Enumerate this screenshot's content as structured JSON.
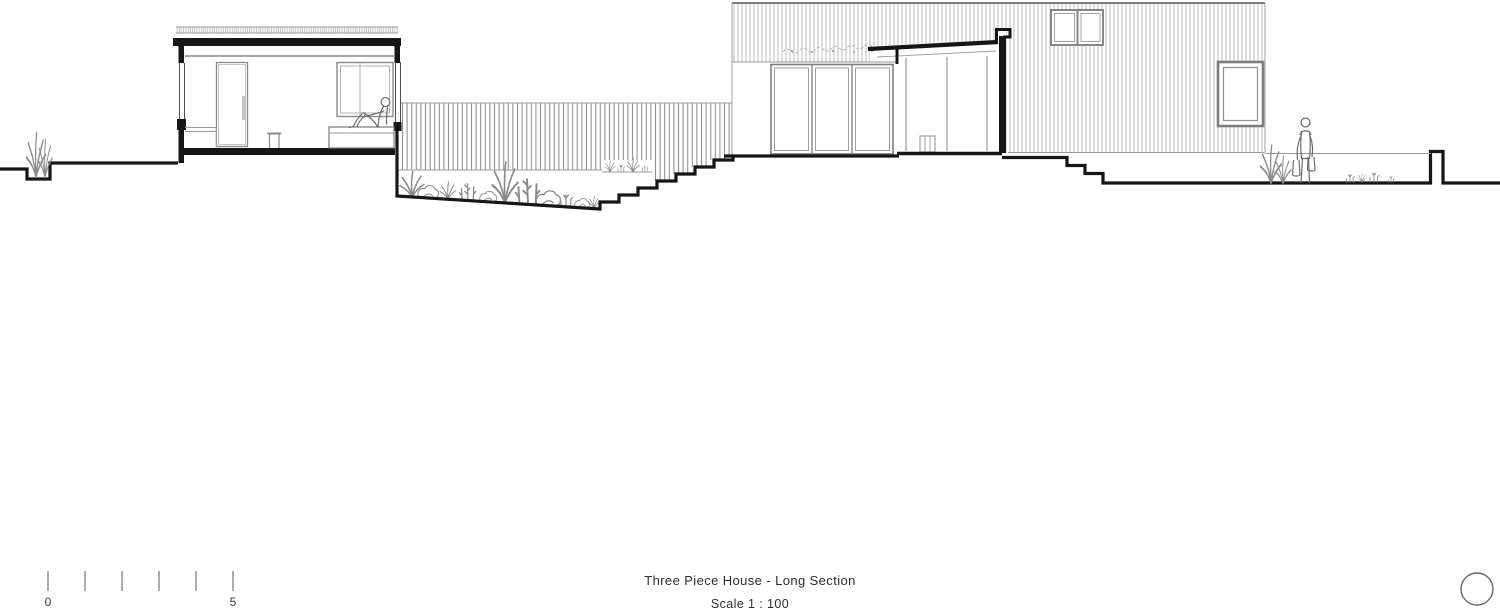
{
  "title_block": {
    "title": "Three Piece House - Long Section",
    "scale_label": "Scale 1 : 100"
  },
  "scale_bar": {
    "start_label": "0",
    "end_label": "5",
    "tick_count": 6
  },
  "colors": {
    "background": "#ffffff",
    "section_line": "#161616",
    "detail_line": "#4d4d4d",
    "frame_line": "#7d7d7d",
    "hatch_line": "#b3b3b3",
    "slat_line": "#8c8c8c",
    "plant_line": "#8a8a8a",
    "figure_line": "#666666",
    "text_color": "#2d2d2d"
  }
}
